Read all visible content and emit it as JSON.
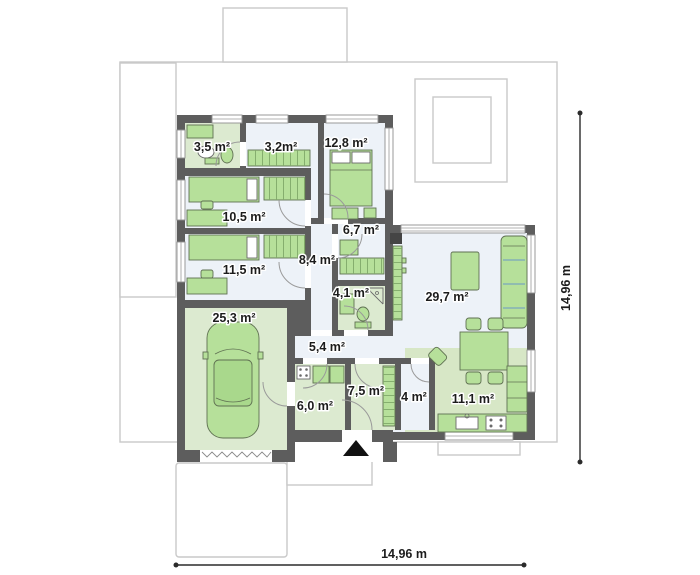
{
  "plan_type": "single-storey house floor plan",
  "rooms": [
    {
      "id": "bathroom-small",
      "label": "3,5 m²"
    },
    {
      "id": "wardrobe-hall",
      "label": "3,2m²"
    },
    {
      "id": "bedroom-1",
      "label": "12,8 m²"
    },
    {
      "id": "bedroom-2",
      "label": "10,5 m²"
    },
    {
      "id": "study",
      "label": "6,7 m²"
    },
    {
      "id": "bedroom-3",
      "label": "11,5 m²"
    },
    {
      "id": "hallway",
      "label": "8,4 m²"
    },
    {
      "id": "bathroom",
      "label": "4,1 m²"
    },
    {
      "id": "living-room",
      "label": "29,7 m²"
    },
    {
      "id": "garage",
      "label": "25,3 m²"
    },
    {
      "id": "corridor",
      "label": "5,4 m²"
    },
    {
      "id": "utility-room",
      "label": "6,0 m²"
    },
    {
      "id": "entrance-hall",
      "label": "7,5 m²"
    },
    {
      "id": "pantry",
      "label": "4 m²"
    },
    {
      "id": "kitchen",
      "label": "11,1 m²"
    }
  ],
  "dimensions": {
    "right_label": "14,96 m",
    "bottom_label": "14,96 m"
  },
  "icons": {
    "entrance_arrow": "▲"
  },
  "colors": {
    "wall": "#5d5d5d",
    "floor_light": "#edf2f8",
    "floor_green": "#dcead0",
    "furniture_green": "#b6e09a",
    "plot_line": "#c9c9c9",
    "sofa_accent_blue": "#6b98c6",
    "dimension_line": "#2b2b2b"
  }
}
